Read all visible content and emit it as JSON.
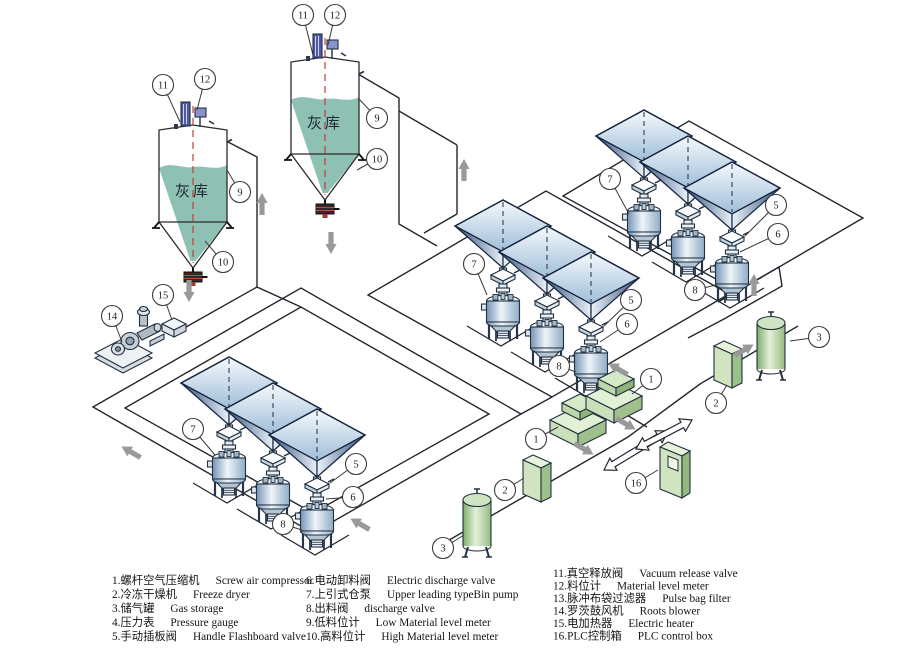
{
  "diagram_title": "Pneumatic ash conveying system diagram",
  "silos": [
    {
      "label": "灰库"
    },
    {
      "label": "灰库"
    }
  ],
  "callouts": [
    {
      "label": "11"
    },
    {
      "label": "12"
    },
    {
      "label": "9"
    },
    {
      "label": "10"
    },
    {
      "label": "15"
    },
    {
      "label": "14"
    },
    {
      "label": "11"
    },
    {
      "label": "12"
    },
    {
      "label": "9"
    },
    {
      "label": "10"
    },
    {
      "label": "7"
    },
    {
      "label": "5"
    },
    {
      "label": "6"
    },
    {
      "label": "8"
    },
    {
      "label": "7"
    },
    {
      "label": "5"
    },
    {
      "label": "6"
    },
    {
      "label": "8"
    },
    {
      "label": "7"
    },
    {
      "label": "5"
    },
    {
      "label": "6"
    },
    {
      "label": "8"
    },
    {
      "label": "1"
    },
    {
      "label": "2"
    },
    {
      "label": "3"
    },
    {
      "label": "1"
    },
    {
      "label": "2"
    },
    {
      "label": "3"
    },
    {
      "label": "16"
    }
  ],
  "legend": {
    "columns": [
      {
        "items": [
          {
            "zh": "1.螺杆空气压缩机",
            "en": "Screw air compressor"
          },
          {
            "zh": "2.冷冻干燥机",
            "en": "Freeze dryer"
          },
          {
            "zh": "3.储气罐",
            "en": "Gas storage"
          },
          {
            "zh": "4.压力表",
            "en": "Pressure gauge"
          },
          {
            "zh": "5.手动插板阀",
            "en": "Handle Flashboard valve"
          }
        ]
      },
      {
        "items": [
          {
            "zh": "6.电动卸料阀",
            "en": "Electric discharge valve"
          },
          {
            "zh": "7.上引式仓泵",
            "en": "Upper leading typeBin pump"
          },
          {
            "zh": "8.出料阀",
            "en": "discharge valve"
          },
          {
            "zh": "9.低料位计",
            "en": "Low  Material level meter"
          },
          {
            "zh": "10.高料位计",
            "en": "High Material level meter"
          }
        ]
      },
      {
        "items": [
          {
            "zh": "11.真空释放阀",
            "en": "Vacuum release valve"
          },
          {
            "zh": "12.料位计",
            "en": "Material level meter"
          },
          {
            "zh": "13.脉冲布袋过滤器",
            "en": "Pulse bag filter"
          },
          {
            "zh": "14.罗茨鼓风机",
            "en": "Roots blower"
          },
          {
            "zh": "15.电加热器",
            "en": "Electric heater"
          },
          {
            "zh": "16.PLC控制箱",
            "en": "PLC control box"
          }
        ]
      }
    ]
  },
  "colors": {
    "hopper_blue_dark": "#31507c",
    "hopper_blue_light": "#edf4fa",
    "silo_teal": "#8fc0b4",
    "equipment_green": "#cfe4bf",
    "centerline_red": "#bf4030",
    "flow_arrow_gray": "#999999",
    "line_dark": "#23262e",
    "filter_purple": "#4f59a6"
  }
}
